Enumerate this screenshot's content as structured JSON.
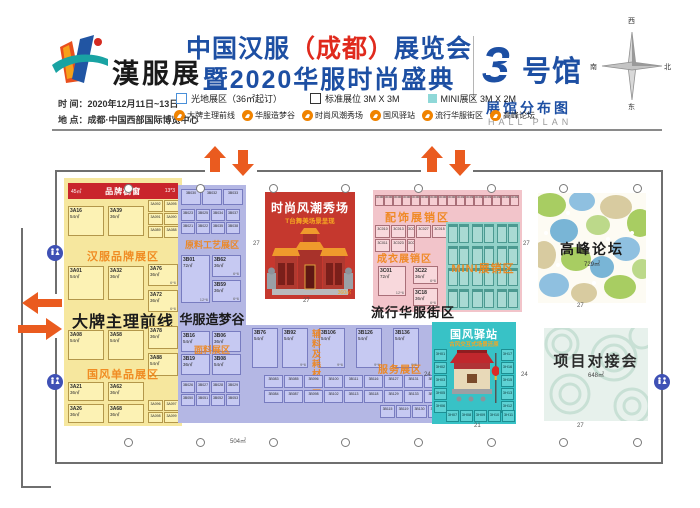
{
  "header": {
    "logo_text": "漢服展",
    "title1_pre": "中国汉服",
    "title1_paren": "（成都）",
    "title1_post": "展览会",
    "title2": "暨2020华服时尚盛典",
    "time": "时 间：2020年12月11日~13日",
    "venue": "地 点：成都·中国西部国际博览中心",
    "hall_no": "3",
    "hall_word": "号馆",
    "plan_cn": "展馆分布图",
    "plan_en": "HALL PLAN",
    "compass": {
      "top": "西",
      "right": "北",
      "bottom": "东",
      "left": "南"
    }
  },
  "legend": {
    "open": "光地展区（36㎡起订）",
    "standard": "标准展位 3M X 3M",
    "mini": "MINI展区 3M X 2M",
    "zones": [
      "大牌主理前线",
      "华服造梦谷",
      "时尚风潮秀场",
      "国风驿站",
      "流行华服街区",
      "高峰论坛"
    ]
  },
  "colors": {
    "title_blue": "#1d4fa3",
    "accent_orange": "#f08300",
    "stage_red": "#c5382e",
    "zone_yellow": "#f6e79e",
    "zone_purple": "#b4b7e4",
    "zone_pink": "#f2c4ca",
    "zone_mini_teal": "#93d2c9",
    "zone_cyan": "#38c2c6",
    "arrow_orange": "#ea5b1f"
  },
  "plan": {
    "yellow": {
      "banner": {
        "left": "45㎡",
        "title": "品牌橱窗",
        "right": "13*3"
      },
      "watermark1": "汉服品牌展区",
      "watermark2": "国风单品展区",
      "label": "大牌主理前线",
      "g1": [
        {
          "id": "3A16",
          "size": "54㎡"
        },
        {
          "id": "3A39",
          "size": "36㎡"
        }
      ],
      "g1r": [
        "3A092",
        "3A095",
        "3A091",
        "3A090",
        "3A089",
        "3A088"
      ],
      "g2": [
        {
          "id": "3A01",
          "size": "54㎡"
        },
        {
          "id": "3A32",
          "size": "36㎡"
        }
      ],
      "g2r": [
        {
          "id": "3A76",
          "size": "36㎡",
          "note": "6*6"
        },
        {
          "id": "3A72",
          "size": "36㎡",
          "note": "6*6"
        }
      ],
      "g3": [
        {
          "id": "3A08",
          "size": "54㎡"
        },
        {
          "id": "3A58",
          "size": "54㎡"
        }
      ],
      "g3r": [
        {
          "id": "3A78",
          "size": "36㎡"
        },
        {
          "id": "3A88",
          "size": "54㎡"
        }
      ],
      "g4": [
        {
          "id": "3A21",
          "size": "36㎡"
        },
        {
          "id": "3A62",
          "size": "36㎡"
        },
        {
          "id": "3A26",
          "size": "36㎡"
        },
        {
          "id": "3A68",
          "size": "36㎡"
        }
      ],
      "g4r": [
        "3A096",
        "3A097",
        "3A098",
        "3A099"
      ]
    },
    "purple": {
      "label": "华服造梦谷",
      "wm_top": "原料工艺展区",
      "wm_mid": "面料展区",
      "wm_vert": "辅料及耗材展区",
      "wm_service": "服务展区",
      "t0": [
        "3B030",
        "3B032",
        "3B033"
      ],
      "t1": [
        "3B023",
        "3B025",
        "3B034",
        "3B037",
        "3B021",
        "3B022",
        "3B035",
        "3B038"
      ],
      "m1": [
        {
          "id": "3B01",
          "size": "72㎡",
          "note": "12*6"
        }
      ],
      "m2": [
        {
          "id": "3B62",
          "size": "36㎡",
          "note": "6*6"
        },
        {
          "id": "3B59",
          "size": "36㎡",
          "note": "6*6"
        }
      ],
      "l1": [
        {
          "id": "3B16",
          "size": "54㎡"
        },
        {
          "id": "3B19",
          "size": "36㎡"
        }
      ],
      "l2": [
        {
          "id": "3B06",
          "size": "36㎡"
        },
        {
          "id": "3B08",
          "size": "54㎡"
        }
      ],
      "lp": [
        "3B026",
        "3B027",
        "3B028",
        "3B029",
        "3B050",
        "3B051",
        "3B052",
        "3B053"
      ],
      "r0": [
        {
          "id": "3B76",
          "size": "54㎡"
        }
      ],
      "r1": [
        {
          "id": "3B92",
          "size": "54㎡",
          "note": "9*6"
        },
        {
          "id": "3B106",
          "size": "54㎡",
          "note": "9*6"
        },
        {
          "id": "3B126",
          "size": "54㎡",
          "note": "9*6"
        },
        {
          "id": "3B136",
          "size": "54㎡",
          "note": "9*6"
        }
      ],
      "b1": [
        "3B083",
        "3B085",
        "3B096",
        "3B100",
        "3B111",
        "3B116",
        "3B127",
        "3B131",
        "3B152",
        "3B157"
      ],
      "b2": [
        "3B084",
        "3B087",
        "3B098",
        "3B102",
        "3B113",
        "3B118",
        "3B129",
        "3B133",
        "3B153",
        "3B158"
      ],
      "b3": [
        "3B115",
        "3B119",
        "3B130",
        "3B135",
        "3B156",
        "3B160"
      ]
    },
    "stage": {
      "title": "时尚风潮秀场",
      "subtitle": "T台舞美场景呈现",
      "area": "360㎡"
    },
    "pink": {
      "label": "流行华服街区",
      "wm1": "配饰展销区",
      "wm2": "成衣展销区",
      "wm_mini": "MINI展销区",
      "strip": [
        "3C001",
        "3C002",
        "3C003",
        "3C004",
        "3C005",
        "3C006",
        "3C007",
        "3C008",
        "3C009",
        "3C030",
        "3C031",
        "3C032",
        "3C033",
        "3C034",
        "3C035",
        "3C036"
      ],
      "pairs": [
        "3C010",
        "3C013",
        "3C026",
        "3C027",
        "3C015",
        "3C011",
        "3C023",
        "3C025"
      ],
      "booth1": [
        {
          "id": "3C01",
          "size": "72㎡",
          "note": "12*6"
        }
      ],
      "booth2": [
        {
          "id": "3C22",
          "size": "36㎡",
          "note": "6*6"
        },
        {
          "id": "3C18",
          "size": "36㎡",
          "note": "6*6"
        }
      ]
    },
    "forum": {
      "label": "高峰论坛",
      "area": "729㎡"
    },
    "post": {
      "title": "国风驿站",
      "subtitle": "古风交互式场景还原",
      "left": [
        "3H01",
        "3H02",
        "3H03",
        "3H05",
        "3H06"
      ],
      "right": [
        "3H17",
        "3H16",
        "3H15",
        "3H13",
        "3H12"
      ],
      "bottom": [
        "3H07",
        "3H08",
        "3H09",
        "3H10",
        "3H11"
      ]
    },
    "meeting": {
      "label": "项目对接会",
      "area": "648㎡"
    },
    "aisles": [
      {
        "t": "27",
        "x": 253,
        "y": 241
      },
      {
        "t": "27",
        "x": 303,
        "y": 298
      },
      {
        "t": "27",
        "x": 523,
        "y": 241
      },
      {
        "t": "27",
        "x": 577,
        "y": 303
      },
      {
        "t": "24",
        "x": 424,
        "y": 372
      },
      {
        "t": "24",
        "x": 521,
        "y": 372
      },
      {
        "t": "21",
        "x": 474,
        "y": 423
      },
      {
        "t": "27",
        "x": 577,
        "y": 423
      },
      {
        "t": "504㎡",
        "x": 230,
        "y": 436
      }
    ]
  }
}
